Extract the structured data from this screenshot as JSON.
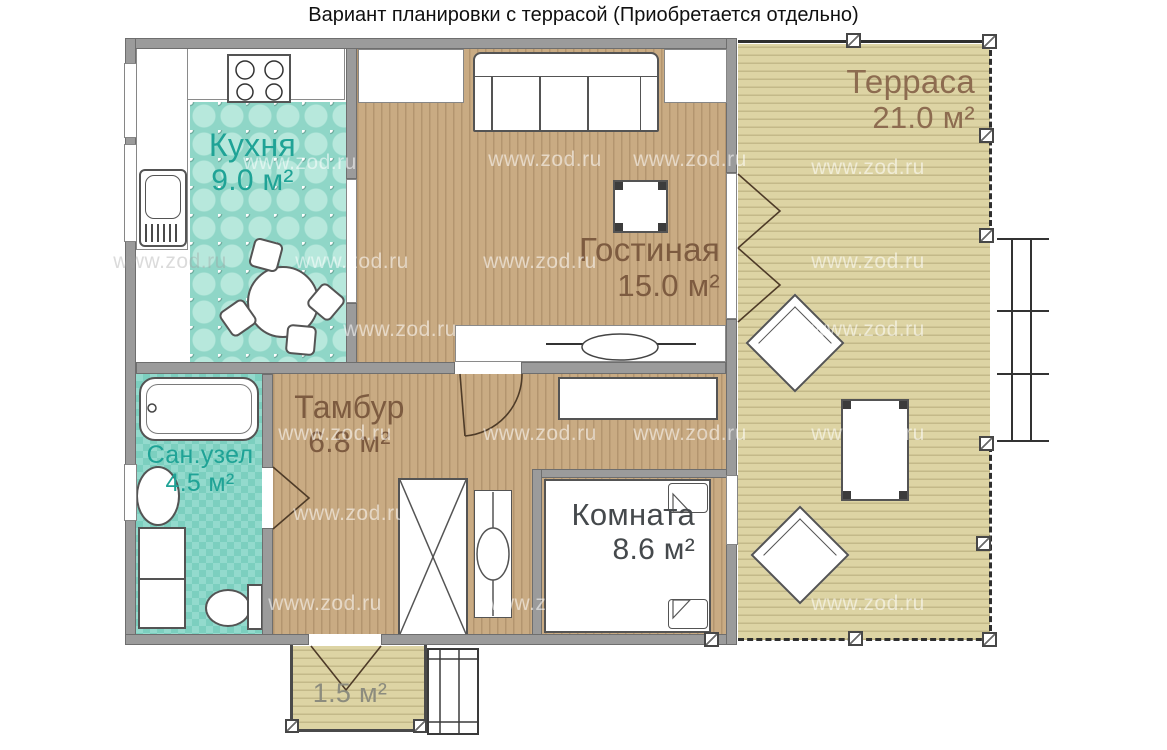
{
  "title": "Вариант планировки с террасой (Приобретается отдельно)",
  "watermark": "www.zod.ru",
  "rooms": {
    "kitchen": {
      "name": "Кухня",
      "area": "9.0 м²"
    },
    "living": {
      "name": "Гостиная",
      "area": "15.0 м²"
    },
    "terrace": {
      "name": "Терраса",
      "area": "21.0 м²"
    },
    "vestibule": {
      "name": "Тамбур",
      "area": "6.8 м²"
    },
    "bathroom": {
      "name": "Сан.узел",
      "area": "4.5 м²"
    },
    "bedroom": {
      "name": "Комната",
      "area": "8.6 м²"
    },
    "porch": {
      "area": "1.5 м²"
    }
  },
  "colors": {
    "wall_gray": "#9b9b9b",
    "wood_floor": "#c9ab83",
    "terrace_floor": "#ddd4a4",
    "kitchen_tile": "#8fd6c7",
    "bathroom_tile": "#93dacd",
    "label_teal": "#1fa396",
    "label_brown": "#7d5b40",
    "label_dark": "#45494c",
    "label_porch": "#8c8c7e"
  }
}
